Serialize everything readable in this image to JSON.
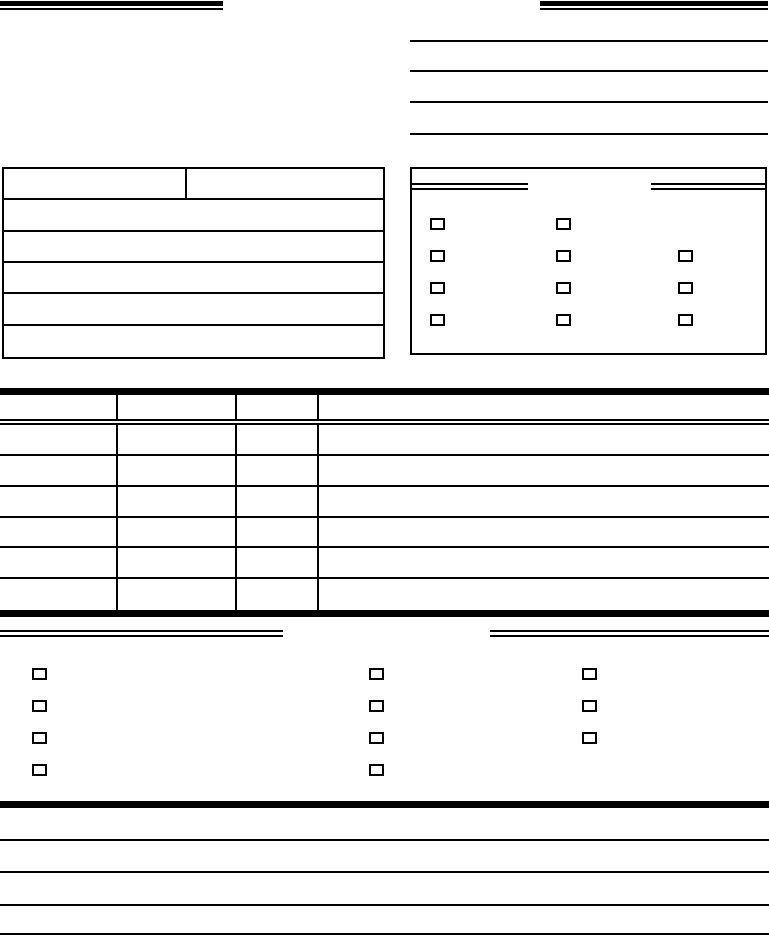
{
  "page": {
    "paper_color": "#ffffff",
    "ink_color": "#000000"
  },
  "header": {
    "write_in_lines": [
      {
        "value": ""
      },
      {
        "value": ""
      },
      {
        "value": ""
      },
      {
        "value": ""
      }
    ]
  },
  "info_table": {
    "rows": [
      {
        "cells": [
          "",
          ""
        ]
      },
      {
        "cells": [
          ""
        ]
      },
      {
        "cells": [
          ""
        ]
      },
      {
        "cells": [
          ""
        ]
      },
      {
        "cells": [
          ""
        ]
      },
      {
        "cells": [
          ""
        ]
      }
    ]
  },
  "checkbox_panel": {
    "heading_left": "",
    "heading_right": "",
    "columns": [
      {
        "boxes": [
          {
            "checked": false
          },
          {
            "checked": false
          },
          {
            "checked": false
          },
          {
            "checked": false
          }
        ]
      },
      {
        "boxes": [
          {
            "checked": false
          },
          {
            "checked": false
          },
          {
            "checked": false
          },
          {
            "checked": false
          }
        ]
      },
      {
        "boxes": [
          {
            "checked": false
          },
          {
            "checked": false
          },
          {
            "checked": false
          }
        ]
      }
    ]
  },
  "items_table": {
    "header_cells": [
      "",
      "",
      "",
      ""
    ],
    "rows": [
      {
        "cells": [
          "",
          "",
          "",
          ""
        ]
      },
      {
        "cells": [
          "",
          "",
          "",
          ""
        ]
      },
      {
        "cells": [
          "",
          "",
          "",
          ""
        ]
      },
      {
        "cells": [
          "",
          "",
          "",
          ""
        ]
      },
      {
        "cells": [
          "",
          "",
          "",
          ""
        ]
      },
      {
        "cells": [
          "",
          "",
          "",
          ""
        ]
      }
    ]
  },
  "options_section": {
    "heading_left": "",
    "heading_right": "",
    "columns": [
      {
        "boxes": [
          {
            "checked": false
          },
          {
            "checked": false
          },
          {
            "checked": false
          },
          {
            "checked": false
          }
        ]
      },
      {
        "boxes": [
          {
            "checked": false
          },
          {
            "checked": false
          },
          {
            "checked": false
          },
          {
            "checked": false
          }
        ]
      },
      {
        "boxes": [
          {
            "checked": false
          },
          {
            "checked": false
          },
          {
            "checked": false
          }
        ]
      }
    ]
  },
  "notes_section": {
    "lines": [
      {
        "value": ""
      },
      {
        "value": ""
      },
      {
        "value": ""
      },
      {
        "value": ""
      }
    ]
  }
}
